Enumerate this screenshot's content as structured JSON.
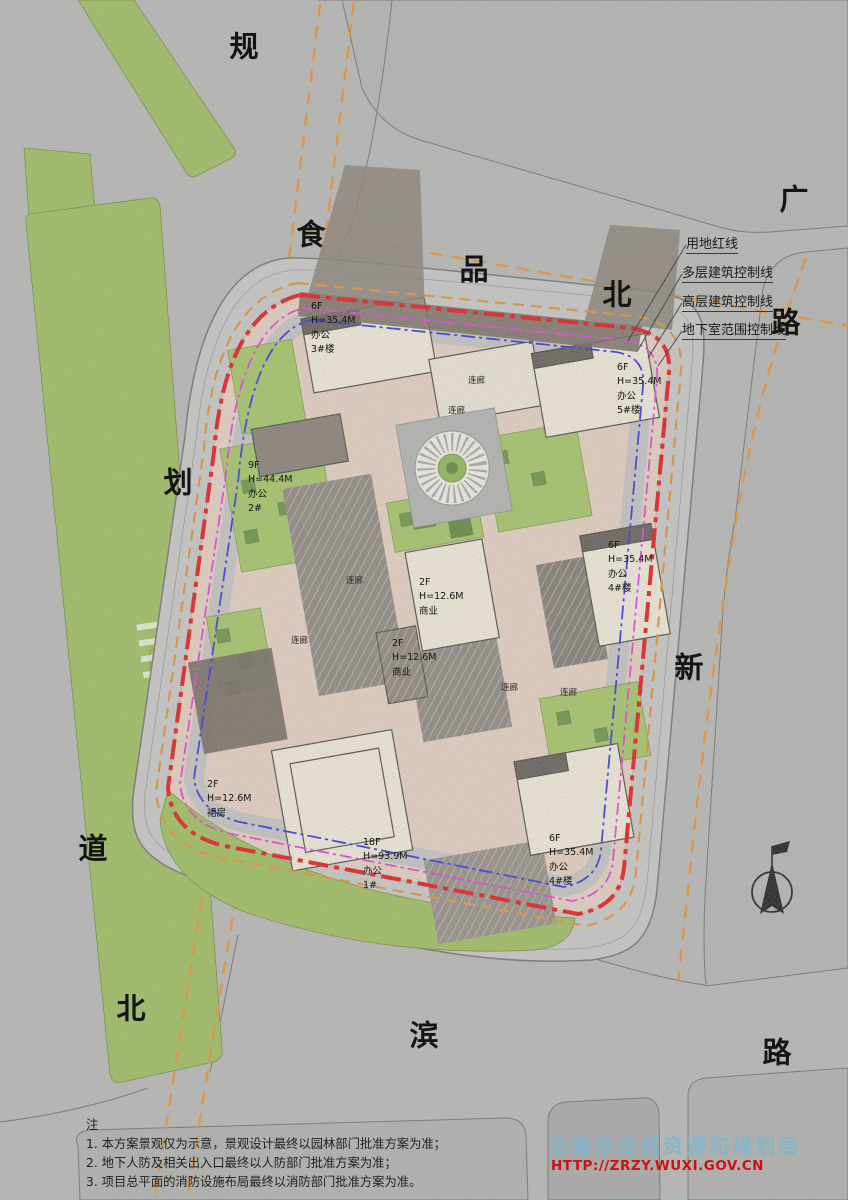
{
  "title": "总平面规划图",
  "roads": {
    "chars": [
      "规",
      "划",
      "道",
      "北",
      "食",
      "品",
      "北",
      "路",
      "广",
      "新",
      "滨",
      "路"
    ]
  },
  "legend": {
    "items": [
      "用地红线",
      "多层建筑控制线",
      "高层建筑控制线",
      "地下室范围控制线"
    ]
  },
  "buildings": [
    {
      "floors": "6F",
      "height": "H=35.4M",
      "use": "办公",
      "no": "3#楼"
    },
    {
      "floors": "6F",
      "height": "H=35.4M",
      "use": "办公",
      "no": "5#楼"
    },
    {
      "floors": "9F",
      "height": "H=44.4M",
      "use": "办公",
      "no": "2#"
    },
    {
      "floors": "6F",
      "height": "H=35.4M",
      "use": "办公",
      "no": "4#楼"
    },
    {
      "floors": "6F",
      "height": "H=35.4M",
      "use": "办公",
      "no": "4#楼"
    },
    {
      "floors": "18F",
      "height": "H=93.9M",
      "use": "办公",
      "no": "1#"
    },
    {
      "floors": "2F",
      "height": "H=12.6M",
      "use": "商业",
      "no": ""
    },
    {
      "floors": "2F",
      "height": "H=12.6M",
      "use": "商业",
      "no": ""
    },
    {
      "floors": "2F",
      "height": "H=12.6M",
      "use": "裙房",
      "no": ""
    }
  ],
  "labels": {
    "corridor": "连廊"
  },
  "notes": {
    "title": "注",
    "items": [
      "1. 本方案景观仅为示意，景观设计最终以园林部门批准方案为准；",
      "2. 地下人防及相关出入口最终以人防部门批准方案为准；",
      "3. 项目总平面的消防设施布局最终以消防部门批准方案为准。"
    ]
  },
  "watermark": {
    "agency": "无锡市自然资源和规划局",
    "url": "HTTP://ZRZY.WUXI.GOV.CN"
  },
  "colors": {
    "land_red_line": "#e60e0e",
    "multistory_control_line": "#e09030",
    "highrise_control_line": "#e23ad8",
    "basement_control_line": "#2c2ce0",
    "lawn": "#a3c55e",
    "paving": "#e7d1c1",
    "building": "#f4edda",
    "watermark_blue": "#7eb6ce",
    "watermark_red": "#ce1111"
  }
}
